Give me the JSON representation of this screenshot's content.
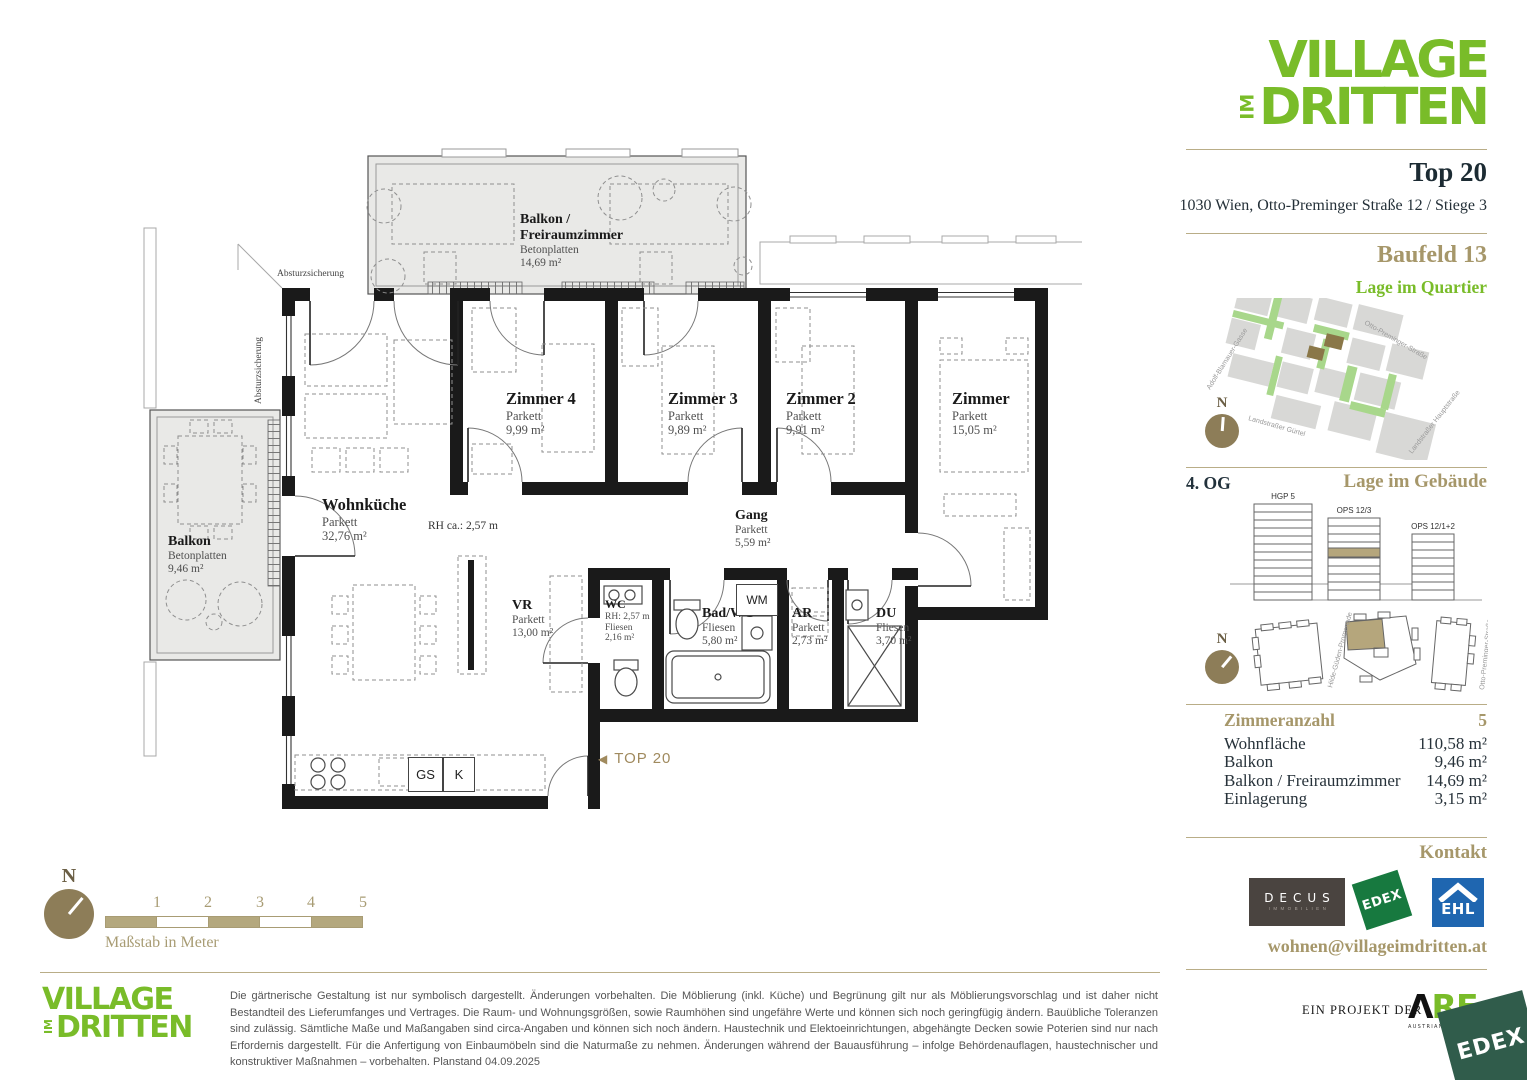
{
  "colors": {
    "brand_green": "#79bc29",
    "tan": "#a6976a",
    "compass_brown": "#8d7d58",
    "ehl_blue": "#1f66b0",
    "edex_green": "#17793f",
    "edex_dark_green": "#305c4b",
    "dark_text": "#1c2b33"
  },
  "brand": {
    "line1": "VILLAGE",
    "im": "IM",
    "line2": "DRITTEN"
  },
  "header": {
    "unit": "Top 20",
    "address": "1030 Wien, Otto-Preminger Straße 12 / Stiege 3"
  },
  "quartier": {
    "title": "Baufeld 13",
    "subtitle": "Lage im Quartier",
    "compass_n": "N",
    "streets": {
      "top": "Otto-Preminger-Straße",
      "left": "Adolf-Blamauer-Gasse",
      "bottom_left": "Landstraßer Gürtel",
      "bottom_right": "Landstraßer Hauptstraße"
    }
  },
  "gebaeude": {
    "floor": "4. OG",
    "title": "Lage im Gebäude",
    "compass_n": "N",
    "buildings": {
      "b1": "HGP 5",
      "b2": "OPS 12/3",
      "b3": "OPS 12/1+2"
    },
    "streets": {
      "left": "Hilde-Güden-Promenade",
      "right": "Otto-Preminger-Straße"
    }
  },
  "facts": {
    "rows": [
      {
        "label": "Zimmeranzahl",
        "value": "5"
      },
      {
        "label": "Wohnfläche",
        "value": "110,58 m²"
      },
      {
        "label": "Balkon",
        "value": "9,46 m²"
      },
      {
        "label": "Balkon / Freiraumzimmer",
        "value": "14,69 m²"
      },
      {
        "label": "Einlagerung",
        "value": "3,15 m²"
      }
    ]
  },
  "kontakt": {
    "title": "Kontakt",
    "email": "wohnen@villageimdritten.at",
    "decus": {
      "name": "DECUS",
      "sub": "IMMOBILIEN"
    },
    "edex": "EDEX",
    "ehl": "EHL"
  },
  "plan": {
    "balkon_top": {
      "name1": "Balkon /",
      "name2": "Freiraumzimmer",
      "finish": "Betonplatten",
      "area": "14,69 m²"
    },
    "balkon_left": {
      "name": "Balkon",
      "finish": "Betonplatten",
      "area": "9,46 m²"
    },
    "wohnkueche": {
      "name": "Wohnküche",
      "finish": "Parkett",
      "area": "32,76 m²"
    },
    "rh_note": "RH ca.: 2,57 m",
    "zimmer4": {
      "name": "Zimmer 4",
      "finish": "Parkett",
      "area": "9,99 m²"
    },
    "zimmer3": {
      "name": "Zimmer 3",
      "finish": "Parkett",
      "area": "9,89 m²"
    },
    "zimmer2": {
      "name": "Zimmer 2",
      "finish": "Parkett",
      "area": "9,91 m²"
    },
    "zimmer": {
      "name": "Zimmer",
      "finish": "Parkett",
      "area": "15,05 m²"
    },
    "gang": {
      "name": "Gang",
      "finish": "Parkett",
      "area": "5,59 m²"
    },
    "vr": {
      "name": "VR",
      "finish": "Parkett",
      "area": "13,00 m²"
    },
    "wc": {
      "name": "WC",
      "rh": "RH: 2,57 m",
      "finish": "Fliesen",
      "area": "2,16 m²"
    },
    "badwc": {
      "name": "Bad/WC",
      "finish": "Fliesen",
      "area": "5,80 m²"
    },
    "ar": {
      "name": "AR",
      "finish": "Parkett",
      "area": "2,73 m²"
    },
    "du": {
      "name": "DU",
      "finish": "Fliesen",
      "area": "3,70 m²"
    },
    "wm": "WM",
    "gs": "GS",
    "k": "K",
    "entry_arrow": "◀",
    "entry": "TOP 20",
    "absturz1": "Absturzsicherung",
    "absturz2": "Absturzsicherung"
  },
  "scalebar": {
    "numbers": [
      "1",
      "2",
      "3",
      "4",
      "5"
    ],
    "label": "Maßstab in Meter",
    "compass_n": "N"
  },
  "footer": {
    "disclaimer": "Die gärtnerische Gestaltung ist nur symbolisch dargestellt. Änderungen vorbehalten. Die Möblierung (inkl. Küche) und Begrünung gilt nur als Möblierungsvorschlag und ist daher nicht Bestandteil des Lieferumfanges und Vertrages. Die Raum- und Wohnungsgrößen, sowie Raumhöhen sind ungefähre Werte und können sich noch geringfügig ändern. Bauübliche Toleranzen sind zulässig. Sämtliche Maße und Maßangaben sind circa-Angaben und können sich noch ändern. Haustechnik und Elektoeinrichtungen, abgehängte Decken sowie Poterien sind nur nach Erfordernis dargestellt. Für die Anfertigung von Einbaumöbeln sind die Naturmaße zu nehmen. Änderungen während der Bauausführung – infolge Behördenauflagen, haustechnischer und konstruktiver Maßnahmen – vorbehalten. Planstand 04.09.2025",
    "project": "EIN PROJEKT DER",
    "are": {
      "glyph": "Λ",
      "letters": "RE",
      "sub": "AUSTRIAN REA"
    },
    "edex": "EDEX"
  }
}
